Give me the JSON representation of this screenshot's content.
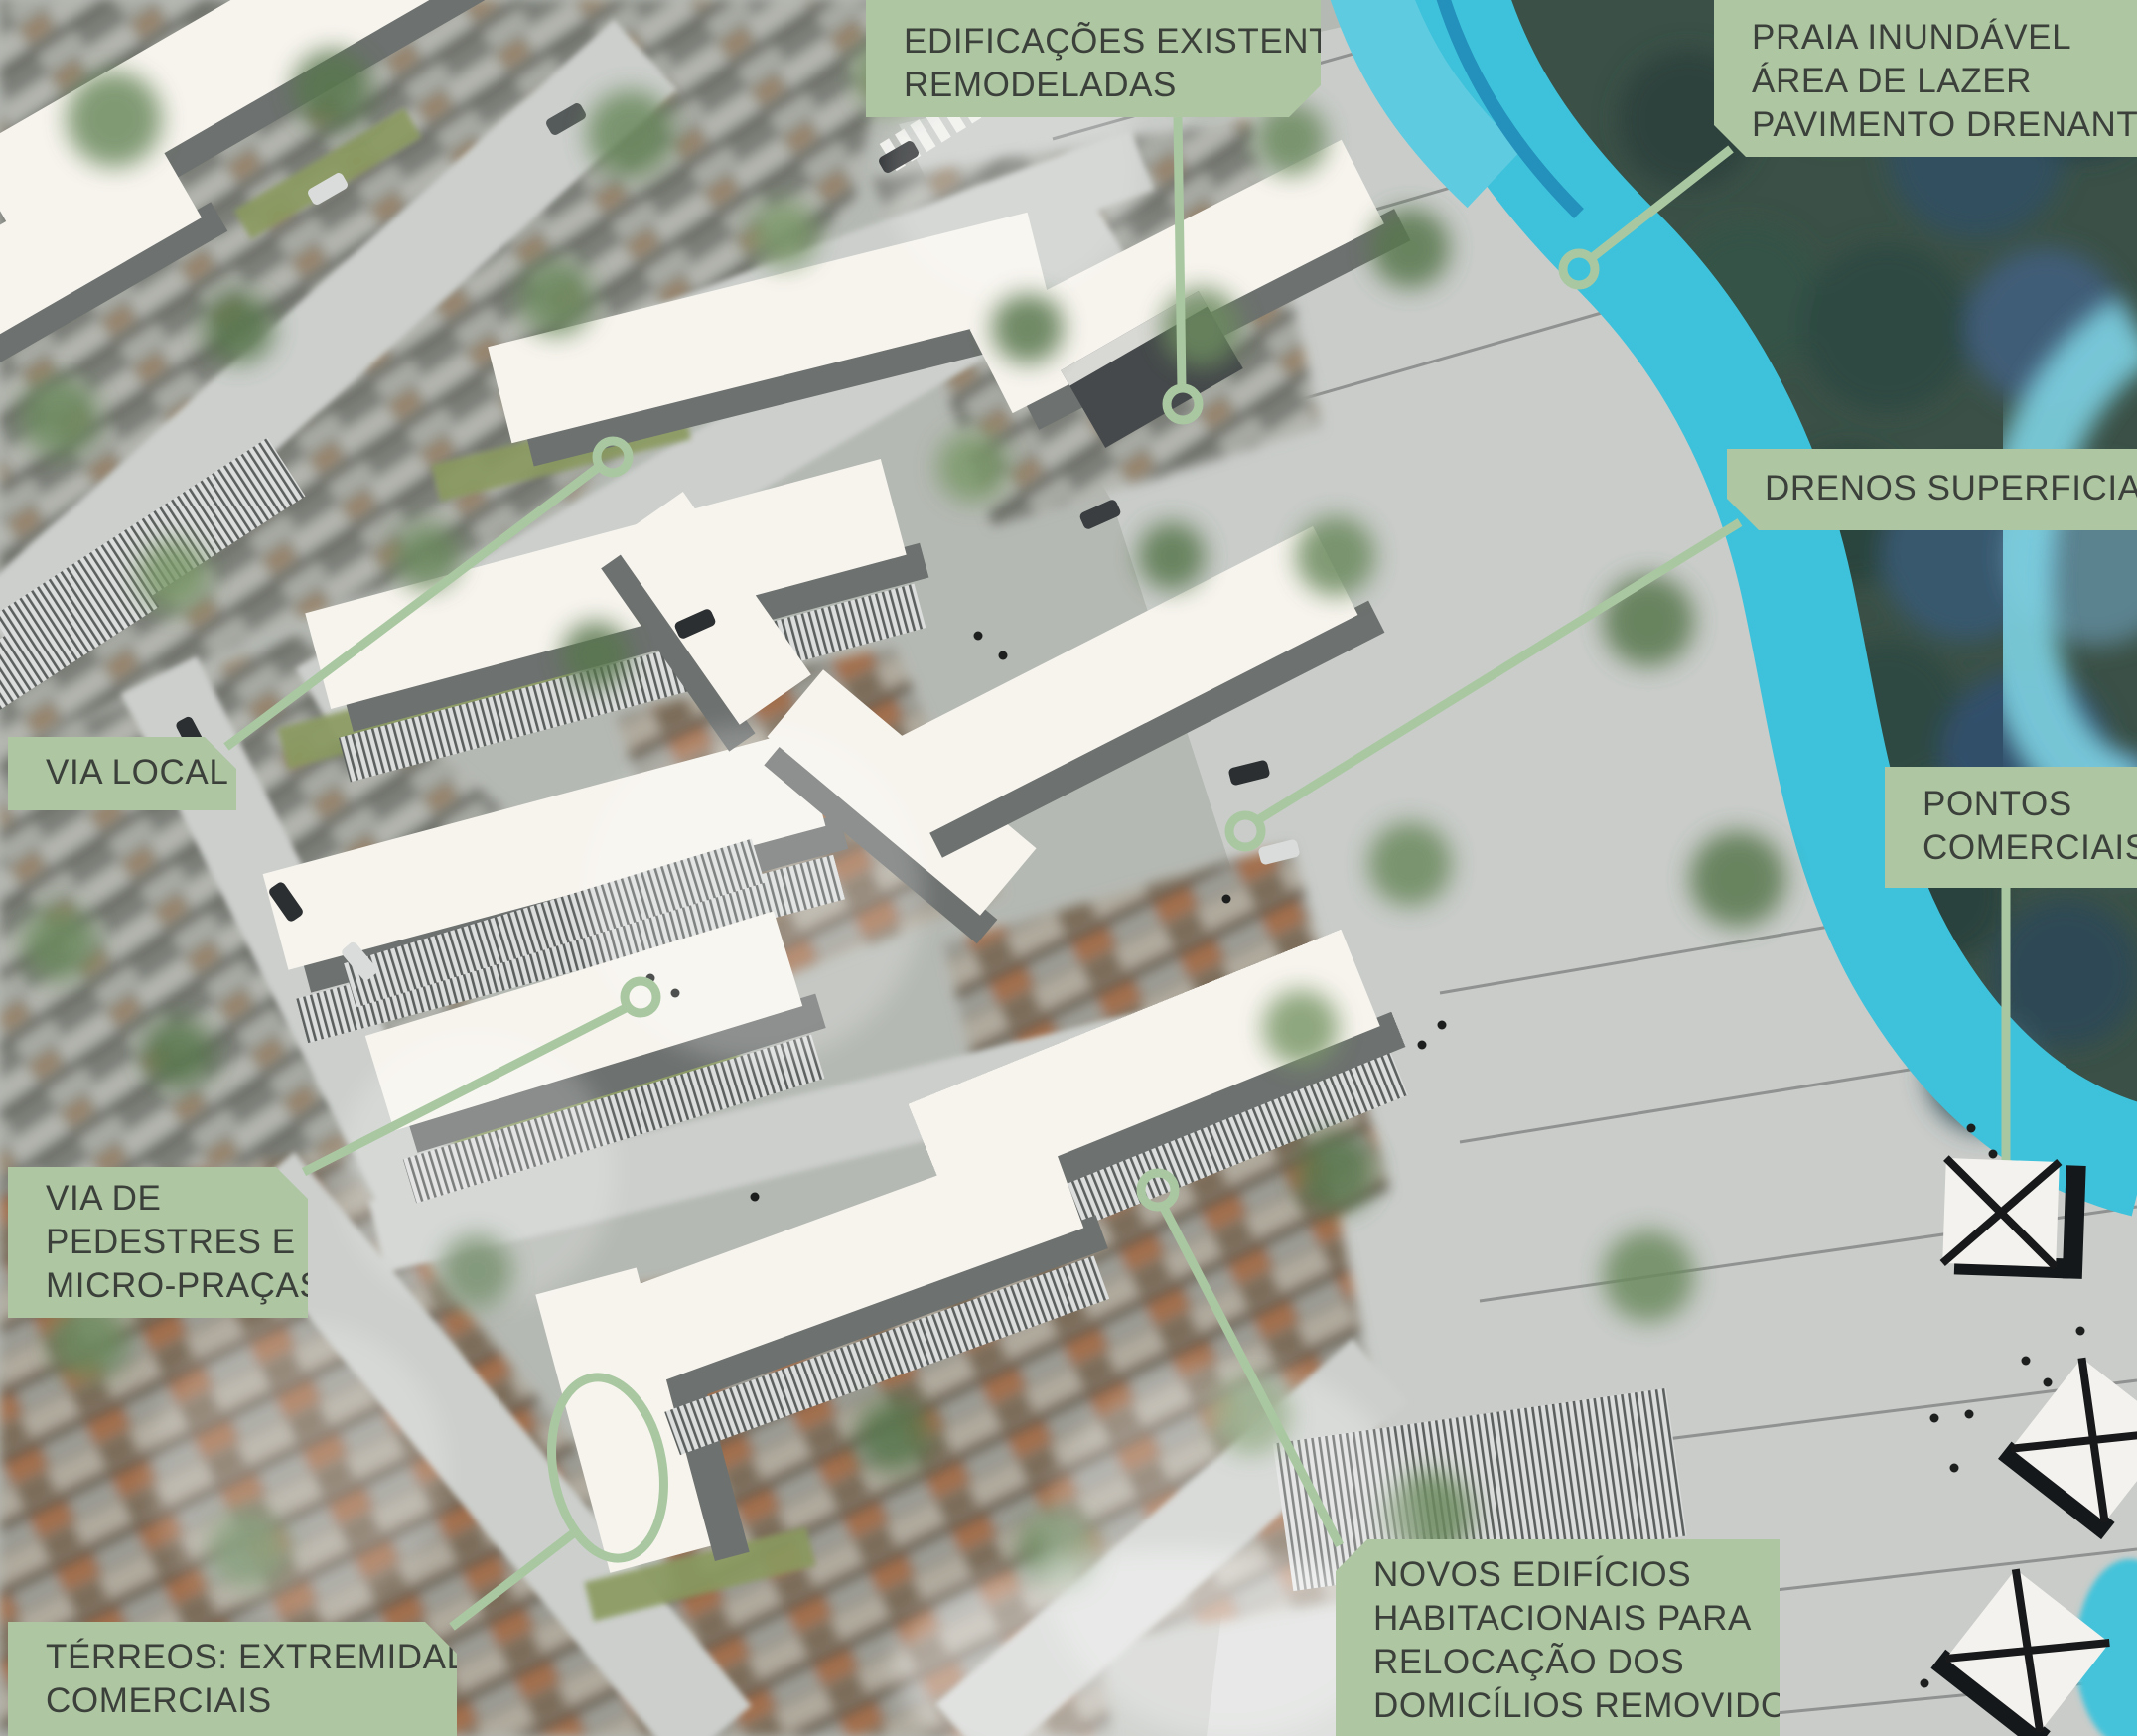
{
  "figure": {
    "kind": "urban design masterplan — annotated aerial plan",
    "language": "pt-BR"
  },
  "colors": {
    "label_bg": "#aec6a1",
    "label_text": "#3b403b",
    "leader_green": "#a9c8a1",
    "river_cyan": "#3ec2db",
    "new_building_white": "#f7f4ee",
    "building_shadow_gray": "#6d716f",
    "pavement_gray": "#c9ccc9",
    "forest_dark": "#3b5147"
  },
  "labels": {
    "edificacoes": {
      "lines": [
        "EDIFICAÇÕES EXISTENTES",
        "REMODELADAS"
      ]
    },
    "praia": {
      "lines": [
        "PRAIA INUNDÁVEL",
        "ÁREA DE LAZER",
        "PAVIMENTO DRENANTE"
      ]
    },
    "drenos": {
      "lines": [
        "DRENOS SUPERFICIAIS"
      ]
    },
    "pontos": {
      "lines": [
        "PONTOS",
        "COMERCIAIS"
      ]
    },
    "via_local": {
      "lines": [
        "VIA LOCAL"
      ]
    },
    "via_pedestres": {
      "lines": [
        "VIA DE",
        "PEDESTRES E",
        "MICRO-PRAÇAS"
      ]
    },
    "terreos": {
      "lines": [
        "TÉRREOS: EXTREMIDADES",
        "COMERCIAIS"
      ]
    },
    "novos": {
      "lines": [
        "NOVOS EDIFÍCIOS",
        "HABITACIONAIS PARA",
        "RELOCAÇÃO DOS",
        "DOMICÍLIOS REMOVIDOS"
      ]
    }
  },
  "markers": {
    "pontos_comerciais_1": "x-square-marker",
    "pontos_comerciais_2": "x-square-marker",
    "pontos_comerciais_3": "x-square-marker",
    "terreos_ellipse": "ellipse-highlight",
    "leader_ends": "circle-endpoint"
  }
}
